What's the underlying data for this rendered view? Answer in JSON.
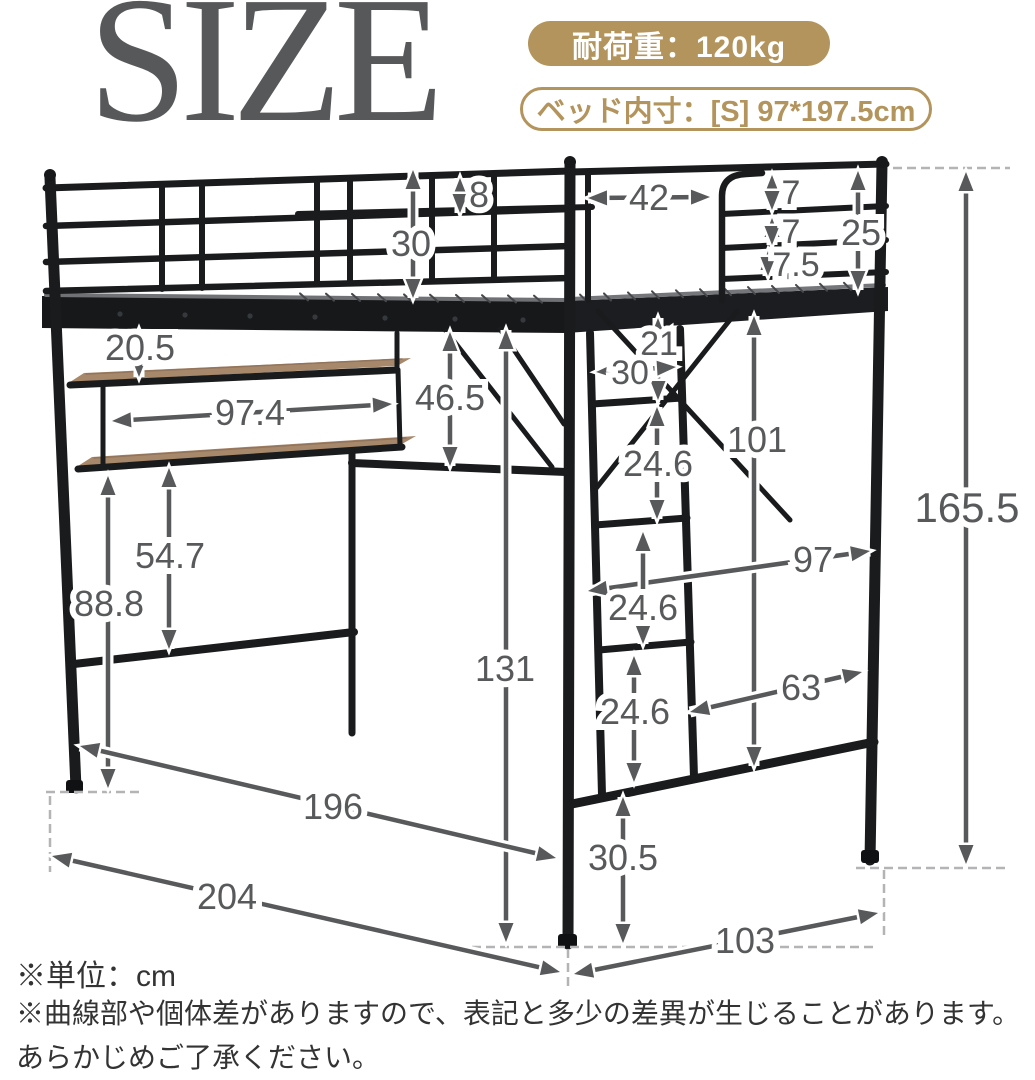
{
  "title": "SIZE",
  "badges": {
    "load_capacity": "耐荷重：120kg",
    "inner_size": "ベッド内寸：[S] 97*197.5cm"
  },
  "dims": {
    "a8": "8",
    "a30g": "30",
    "a42": "42",
    "a7a": "7",
    "a7b": "7",
    "a25": "25",
    "a75": "7.5",
    "a1655": "165.5",
    "a205": "20.5",
    "a974": "97.4",
    "a465": "46.5",
    "a21": "21",
    "a30l": "30",
    "a101": "101",
    "a246a": "24.6",
    "a547": "54.7",
    "a888": "88.8",
    "a97": "97",
    "a131": "131",
    "a246b": "24.6",
    "a246c": "24.6",
    "a63": "63",
    "a305": "30.5",
    "a196": "196",
    "a204": "204",
    "a103": "103"
  },
  "notes": {
    "unit": "※単位：cm",
    "caveat1": "※曲線部や個体差がありますので、表記と多少の差異が生じることがあります。",
    "caveat2": "あらかじめご了承ください。"
  },
  "colors": {
    "accent_gold": "#b3945c",
    "dimension_gray": "#58595b",
    "frame_black": "#1a1b1d",
    "wood": "#a8886a"
  }
}
